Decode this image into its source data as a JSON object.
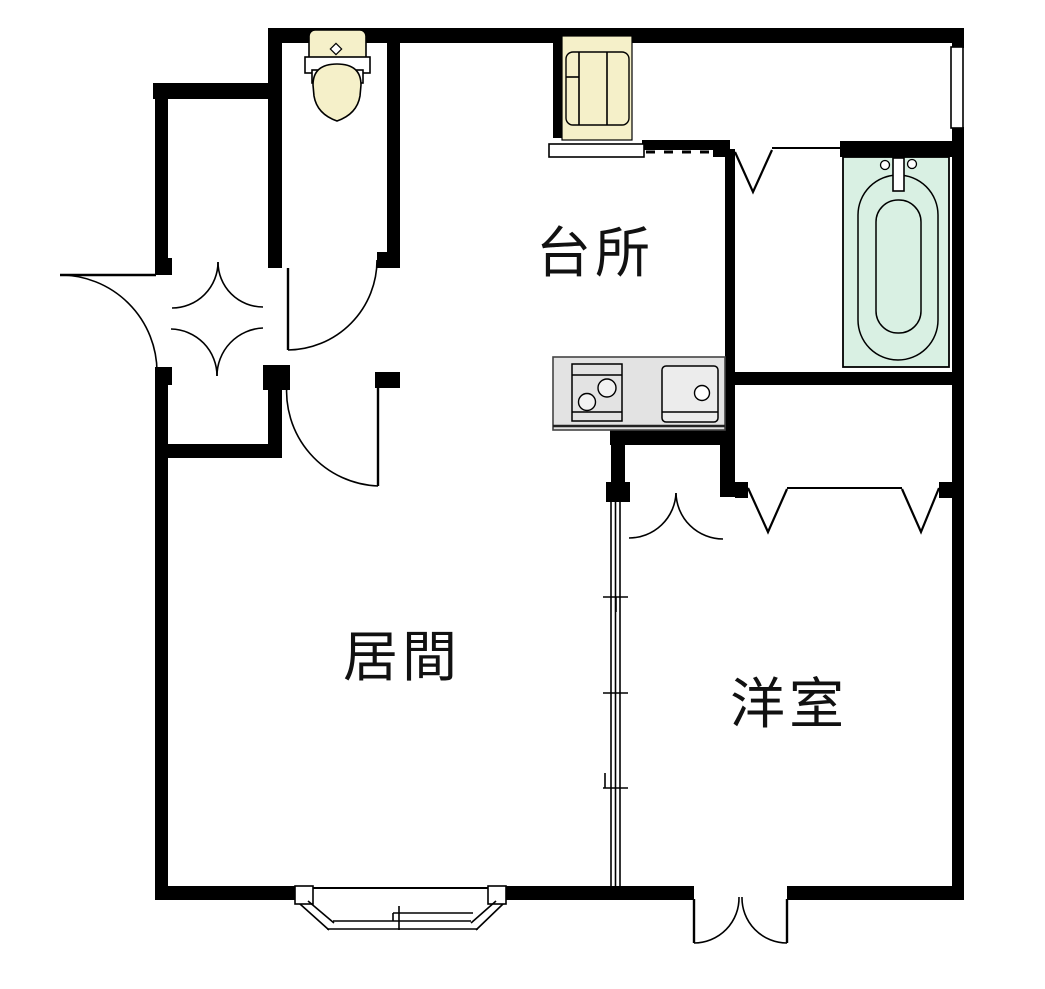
{
  "plan": {
    "title": "apartment-floor-plan",
    "rooms": [
      {
        "id": "kitchen",
        "label": "台所"
      },
      {
        "id": "living-room",
        "label": "居間"
      },
      {
        "id": "western-room",
        "label": "洋室"
      }
    ],
    "fixtures": [
      "toilet-icon",
      "washing-machine-space-icon",
      "bathtub-icon",
      "stove-icon",
      "sink-icon",
      "bay-window",
      "sliding-partition",
      "entrance-door",
      "double-closet-doors",
      "folding-door-v-marks",
      "window"
    ],
    "colors": {
      "wall": "#000000",
      "background": "#ffffff",
      "fixture_cream": "#f5f0c9",
      "bathtub_mint": "#d9f0e3",
      "counter_gray": "#e3e3e3",
      "sink_gray": "#ececec",
      "line": "#000000"
    }
  }
}
